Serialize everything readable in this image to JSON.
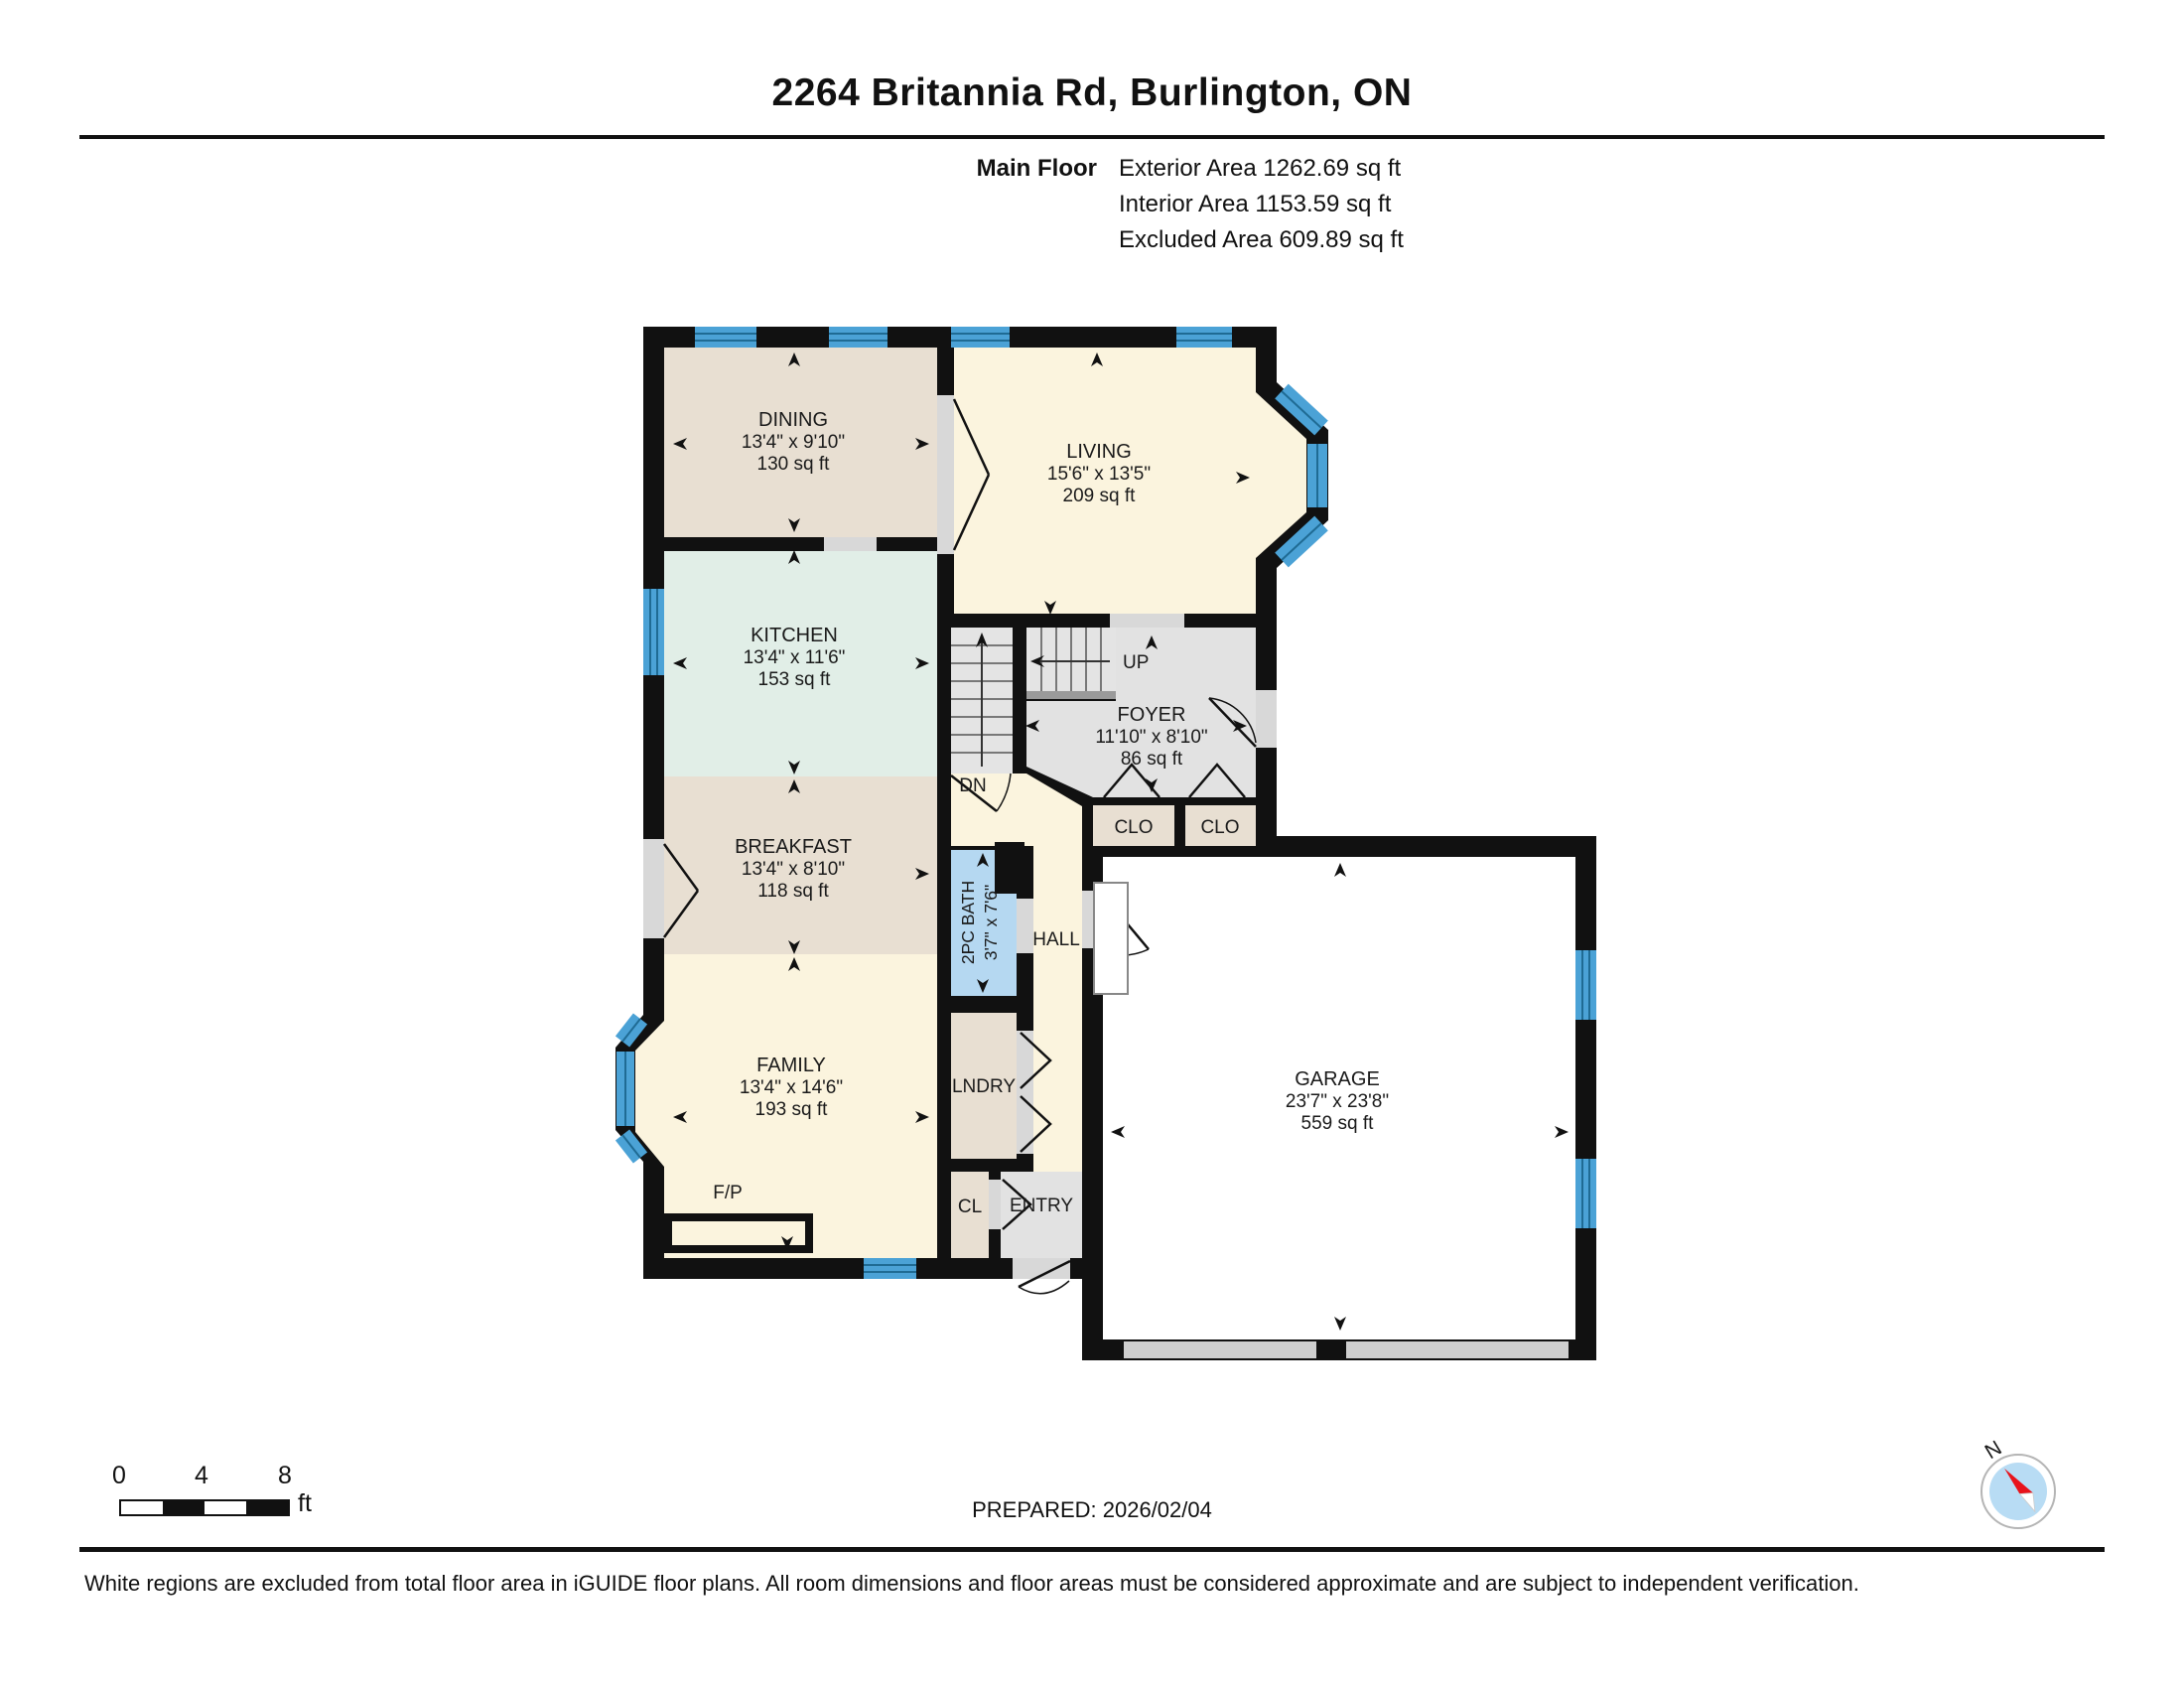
{
  "header": {
    "title": "2264 Britannia Rd, Burlington, ON",
    "floor_label": "Main Floor",
    "exterior": "Exterior Area 1262.69 sq ft",
    "interior": "Interior Area 1153.59 sq ft",
    "excluded": "Excluded Area 609.89 sq ft"
  },
  "rooms": {
    "dining": {
      "name": "DINING",
      "dims": "13'4\" x 9'10\"",
      "area": "130 sq ft"
    },
    "living": {
      "name": "LIVING",
      "dims": "15'6\" x 13'5\"",
      "area": "209 sq ft"
    },
    "kitchen": {
      "name": "KITCHEN",
      "dims": "13'4\" x 11'6\"",
      "area": "153 sq ft"
    },
    "foyer": {
      "name": "FOYER",
      "dims": "11'10\" x 8'10\"",
      "area": "86 sq ft"
    },
    "breakfast": {
      "name": "BREAKFAST",
      "dims": "13'4\" x 8'10\"",
      "area": "118 sq ft"
    },
    "bath": {
      "name": "2PC BATH",
      "dims": "3'7\" x 7'6\""
    },
    "family": {
      "name": "FAMILY",
      "dims": "13'4\" x 14'6\"",
      "area": "193 sq ft"
    },
    "garage": {
      "name": "GARAGE",
      "dims": "23'7\" x 23'8\"",
      "area": "559 sq ft"
    },
    "hall": {
      "name": "HALL"
    },
    "lndry": {
      "name": "LNDRY"
    },
    "cl": {
      "name": "CL"
    },
    "entry": {
      "name": "ENTRY"
    },
    "clo1": {
      "name": "CLO"
    },
    "clo2": {
      "name": "CLO"
    },
    "up": "UP",
    "dn": "DN",
    "fireplace": "F/P"
  },
  "colors": {
    "wall": "#111111",
    "tan": "#e8dfd2",
    "cream": "#fbf4de",
    "green": "#e1eee7",
    "gray": "#e2e2e2",
    "bath_blue": "#b5d8f1",
    "window_blue": "#4ba2d6"
  },
  "scalebar": {
    "t0": "0",
    "t4": "4",
    "t8": "8",
    "unit": "ft"
  },
  "footer": {
    "prepared": "PREPARED: 2026/02/04",
    "disclaimer": "White regions are excluded from total floor area in iGUIDE floor plans. All room dimensions and floor areas must be considered approximate and are subject to independent verification.",
    "compass_n": "N"
  }
}
